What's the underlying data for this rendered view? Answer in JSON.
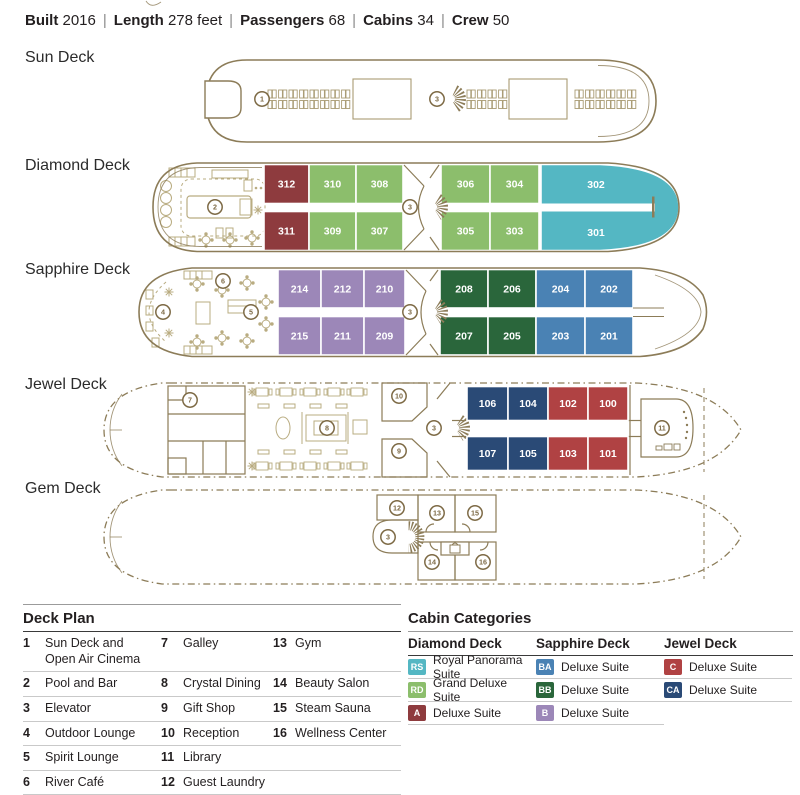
{
  "header": {
    "separator": "|",
    "items": [
      {
        "label": "Built",
        "value": "2016"
      },
      {
        "label": "Length",
        "value": "278 feet"
      },
      {
        "label": "Passengers",
        "value": "68"
      },
      {
        "label": "Cabins",
        "value": "34"
      },
      {
        "label": "Crew",
        "value": "50"
      }
    ]
  },
  "decks": {
    "sun": {
      "label": "Sun Deck",
      "markers": {
        "cinema": "1",
        "elevator": "3"
      }
    },
    "diamond": {
      "label": "Diamond Deck",
      "markers": {
        "pool": "2",
        "elevator": "3"
      },
      "cabins": {
        "t0": {
          "num": "312",
          "color": "#8E3B3E"
        },
        "t1": {
          "num": "310",
          "color": "#8CBE6C"
        },
        "t2": {
          "num": "308",
          "color": "#8CBE6C"
        },
        "t3": {
          "num": "306",
          "color": "#8CBE6C"
        },
        "t4": {
          "num": "304",
          "color": "#8CBE6C"
        },
        "t5": {
          "num": "302",
          "color": "#54B7C3"
        },
        "b0": {
          "num": "311",
          "color": "#8E3B3E"
        },
        "b1": {
          "num": "309",
          "color": "#8CBE6C"
        },
        "b2": {
          "num": "307",
          "color": "#8CBE6C"
        },
        "b3": {
          "num": "305",
          "color": "#8CBE6C"
        },
        "b4": {
          "num": "303",
          "color": "#8CBE6C"
        },
        "b5": {
          "num": "301",
          "color": "#54B7C3"
        }
      }
    },
    "sapphire": {
      "label": "Sapphire Deck",
      "markers": {
        "cafe": "6",
        "outdoor": "4",
        "spirit": "5",
        "elevator": "3"
      },
      "cabins": {
        "t0": {
          "num": "214",
          "color": "#9C87B8"
        },
        "t1": {
          "num": "212",
          "color": "#9C87B8"
        },
        "t2": {
          "num": "210",
          "color": "#9C87B8"
        },
        "t3": {
          "num": "208",
          "color": "#2A663B"
        },
        "t4": {
          "num": "206",
          "color": "#2A663B"
        },
        "t5": {
          "num": "204",
          "color": "#4A82B4"
        },
        "t6": {
          "num": "202",
          "color": "#4A82B4"
        },
        "b0": {
          "num": "215",
          "color": "#9C87B8"
        },
        "b1": {
          "num": "211",
          "color": "#9C87B8"
        },
        "b2": {
          "num": "209",
          "color": "#9C87B8"
        },
        "b3": {
          "num": "207",
          "color": "#2A663B"
        },
        "b4": {
          "num": "205",
          "color": "#2A663B"
        },
        "b5": {
          "num": "203",
          "color": "#4A82B4"
        },
        "b6": {
          "num": "201",
          "color": "#4A82B4"
        }
      }
    },
    "jewel": {
      "label": "Jewel Deck",
      "markers": {
        "galley": "7",
        "dining": "8",
        "reception": "10",
        "gift": "9",
        "elevator": "3",
        "library": "11"
      },
      "cabins": {
        "t0": {
          "num": "106",
          "color": "#2A4A76"
        },
        "t1": {
          "num": "104",
          "color": "#2A4A76"
        },
        "t2": {
          "num": "102",
          "color": "#B04243"
        },
        "t3": {
          "num": "100",
          "color": "#B04243"
        },
        "b0": {
          "num": "107",
          "color": "#2A4A76"
        },
        "b1": {
          "num": "105",
          "color": "#2A4A76"
        },
        "b2": {
          "num": "103",
          "color": "#B04243"
        },
        "b3": {
          "num": "101",
          "color": "#B04243"
        }
      }
    },
    "gem": {
      "label": "Gem Deck",
      "markers": {
        "laundry": "12",
        "elevator": "3",
        "gym": "13",
        "sauna": "15",
        "beauty": "14",
        "wellness": "16"
      }
    }
  },
  "deck_plan": {
    "title": "Deck Plan",
    "rows": [
      [
        {
          "n": "1",
          "t": "Sun Deck and Open Air Cinema"
        },
        {
          "n": "7",
          "t": "Galley"
        },
        {
          "n": "13",
          "t": "Gym"
        }
      ],
      [
        {
          "n": "2",
          "t": "Pool and Bar"
        },
        {
          "n": "8",
          "t": "Crystal Dining"
        },
        {
          "n": "14",
          "t": "Beauty Salon"
        }
      ],
      [
        {
          "n": "3",
          "t": "Elevator"
        },
        {
          "n": "9",
          "t": "Gift Shop"
        },
        {
          "n": "15",
          "t": "Steam Sauna"
        }
      ],
      [
        {
          "n": "4",
          "t": "Outdoor Lounge"
        },
        {
          "n": "10",
          "t": "Reception"
        },
        {
          "n": "16",
          "t": "Wellness Center"
        }
      ],
      [
        {
          "n": "5",
          "t": "Spirit Lounge"
        },
        {
          "n": "11",
          "t": "Library"
        }
      ],
      [
        {
          "n": "6",
          "t": "River Café"
        },
        {
          "n": "12",
          "t": "Guest Laundry"
        }
      ]
    ]
  },
  "cabin_categories": {
    "title": "Cabin Categories",
    "columns": [
      {
        "title": "Diamond Deck",
        "rows": [
          {
            "code": "RS",
            "color": "#54B7C3",
            "label": "Royal Panorama Suite"
          },
          {
            "code": "RD",
            "color": "#8CBE6C",
            "label": "Grand Deluxe Suite"
          },
          {
            "code": "A",
            "color": "#8E3B3E",
            "label": "Deluxe Suite"
          }
        ]
      },
      {
        "title": "Sapphire Deck",
        "rows": [
          {
            "code": "BA",
            "color": "#4A82B4",
            "label": "Deluxe Suite"
          },
          {
            "code": "BB",
            "color": "#2A663B",
            "label": "Deluxe Suite"
          },
          {
            "code": "B",
            "color": "#9C87B8",
            "label": "Deluxe Suite"
          }
        ]
      },
      {
        "title": "Jewel Deck",
        "rows": [
          {
            "code": "C",
            "color": "#B04243",
            "label": "Deluxe Suite"
          },
          {
            "code": "CA",
            "color": "#2A4A76",
            "label": "Deluxe Suite"
          }
        ]
      }
    ]
  }
}
